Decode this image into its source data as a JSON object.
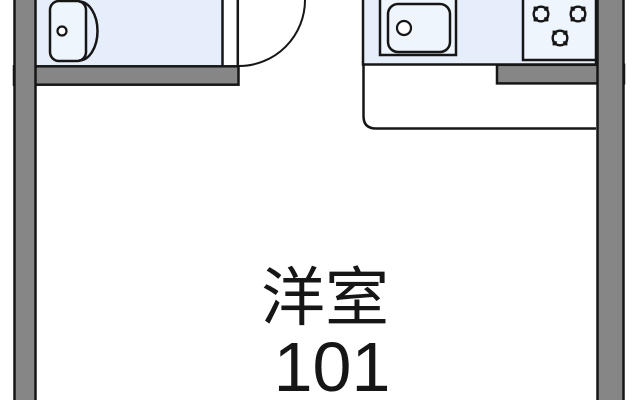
{
  "plan": {
    "room_label": "洋室",
    "room_number": "101"
  },
  "fixtures": {
    "bathtub_icon": "bathtub",
    "sink_icon": "kitchen-sink",
    "stove_icon": "gas-stove-3-burner",
    "door_icon": "door-swing-arc"
  },
  "colors": {
    "wall": "#868686",
    "line": "#161616",
    "area": "#e7eefb",
    "fixture": "#eff5fd",
    "bg": "#ffffff"
  }
}
